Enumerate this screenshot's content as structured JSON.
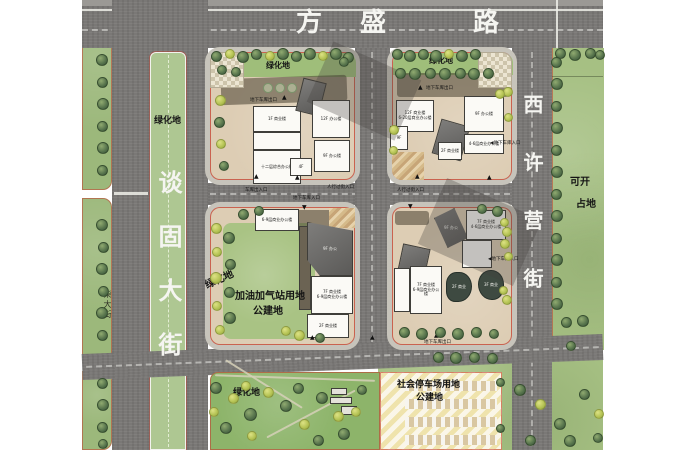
{
  "map": {
    "roads": {
      "fangsheng": "方盛路",
      "fangsheng_chars": [
        "方",
        "盛",
        "路"
      ],
      "tangu": "谈固大街",
      "xixuying": "西许营街",
      "chai": "柴大街"
    },
    "areas": {
      "median_green": "绿化地",
      "block_a_green": "绿化地",
      "block_b_green": "绿化地",
      "block_c_green": "绿化地",
      "park_green": "绿化地",
      "gas_line1": "加油加气站用地",
      "gas_line2": "公建地",
      "parking_line1": "社会停车场用地",
      "parking_line2": "公建地",
      "right_field_line1": "可开",
      "right_field_line2": "占地"
    },
    "markers": {
      "garage_exit": "地下车库出口",
      "garage_entry": "地下车库入口",
      "garage_entry_arrow": "◀地下车库入口",
      "garage_access": "车库出入口",
      "ped_entry": "人行过街入口",
      "tri_up": "▲",
      "tri_down": "▼"
    },
    "buildings": {
      "a1": "1F 商业楼",
      "a2": "十二层综合办公楼",
      "a3": "12F 办公楼",
      "a4": "9F 办公楼",
      "a5": "4F",
      "b1a": "12F 商业楼",
      "b1b": "6-20层商业办公楼",
      "b2": "9F",
      "b3": "9F 办公楼",
      "b4": "4-6层商业办公楼",
      "b5": "2F 商业楼",
      "c1": "6-9层商业办公楼",
      "c_roof": "9F 办公",
      "c2a": "7F 商业楼",
      "c2b": "6-9层商业办公楼",
      "c3": "2F 商业楼",
      "d_roof": "9F 办公",
      "d1a": "7F 商业楼",
      "d1b": "4-6层商业办公楼",
      "d2a": "7F 商业楼",
      "d2b": "6-9层商业办公楼",
      "pond1": "2F 商业",
      "pond2": "3F 商业"
    },
    "colors": {
      "road_gray": "#7a7876",
      "green_field": "#a6c083",
      "median_green": "#aec792",
      "block_ground": "#ddcdb4",
      "building_white": "#fbfaf6",
      "roof_gray": "#6f6e6c",
      "tree_dark": "#53704a",
      "tree_yellow": "#b5c354",
      "boundary_red": "#c8473a",
      "parking_hatch": "#efe3ac",
      "road_text": "#f5f5f1"
    }
  }
}
